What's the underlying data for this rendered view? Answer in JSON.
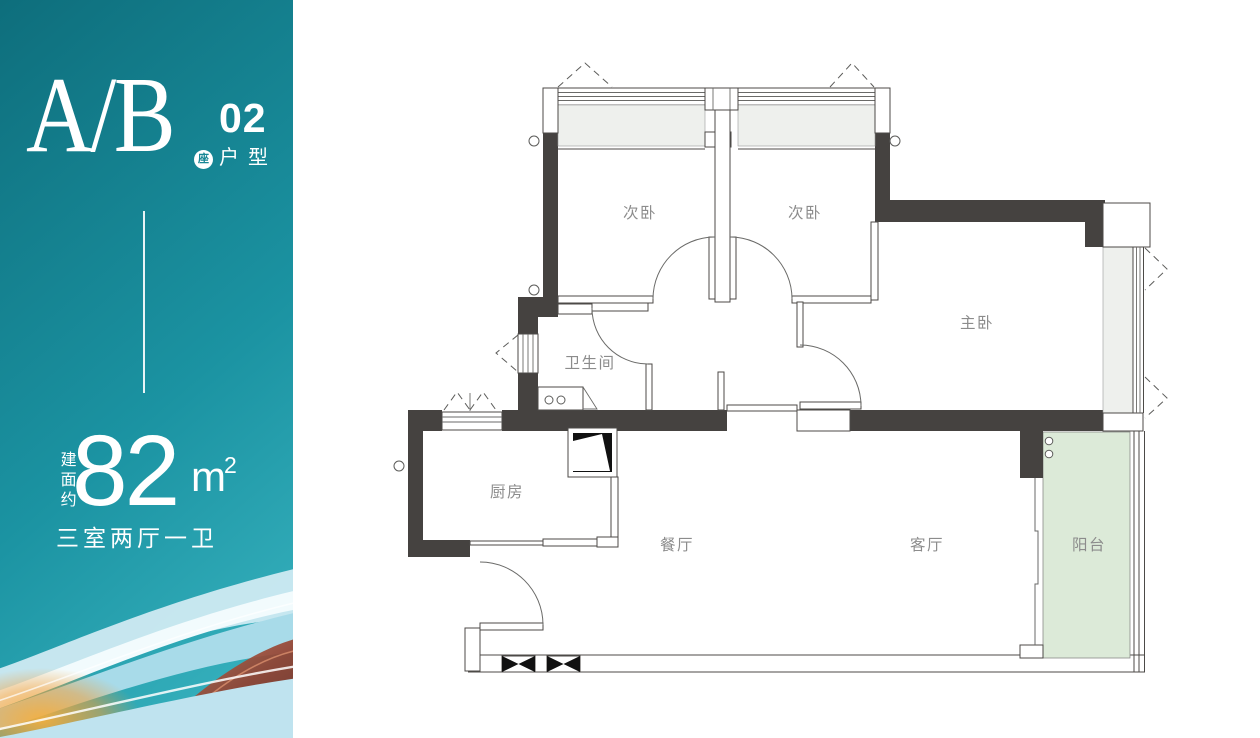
{
  "sidebar": {
    "unit_name": "A/B",
    "unit_badge": "座",
    "unit_number": "02",
    "unit_type_label": "户型",
    "area_prefix": "建面约",
    "area_value": "82",
    "area_unit": "m",
    "area_superscript": "2",
    "layout_summary": "三室两厅一卫",
    "colors": {
      "teal_top": "#0e6e7c",
      "teal_mid": "#1b93a2",
      "teal_bottom": "#3cb7c3"
    }
  },
  "plan": {
    "rooms": [
      {
        "label": "次卧"
      },
      {
        "label": "次卧"
      },
      {
        "label": "主卧"
      },
      {
        "label": "卫生间"
      },
      {
        "label": "厨房"
      },
      {
        "label": "餐厅"
      },
      {
        "label": "客厅"
      },
      {
        "label": "阳台"
      }
    ],
    "colors": {
      "wall": "#454240",
      "balcony_fill": "#dcead8",
      "bay_window_fill": "#eef0ed",
      "label_text": "#8c8c8c"
    }
  }
}
